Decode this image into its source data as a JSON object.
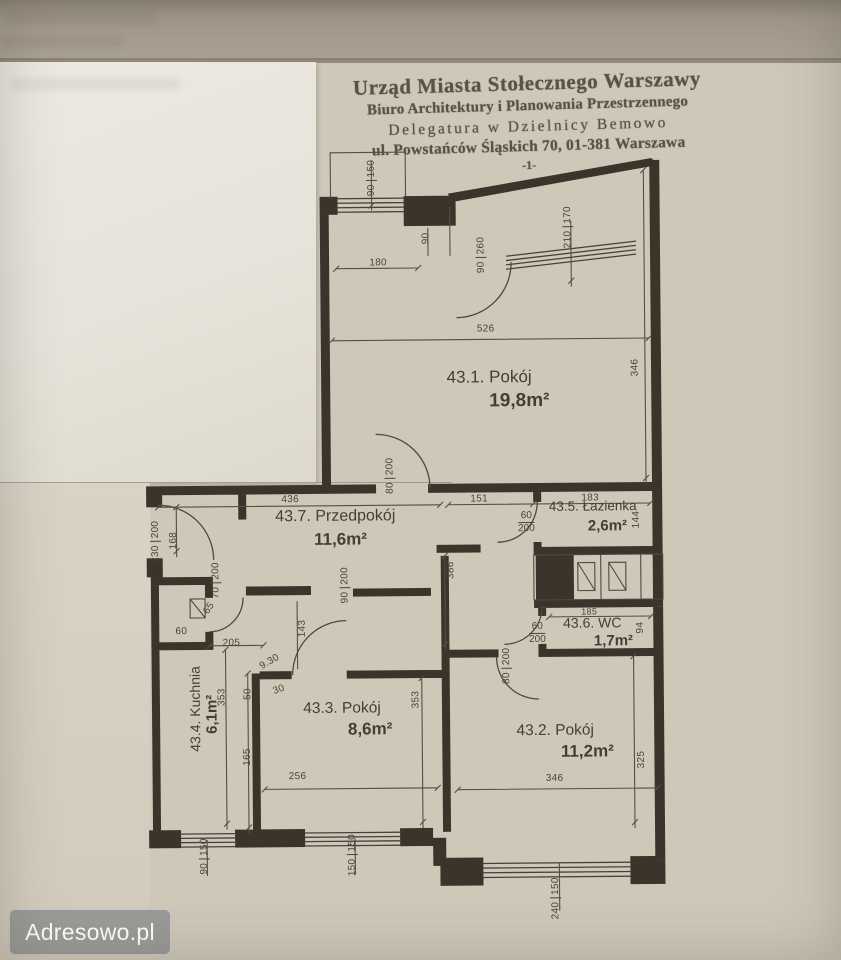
{
  "colors": {
    "paper": "#cfc8b9",
    "white_sheet": "#e9e6df",
    "ink": "#3a342b",
    "stamp_ink": "#575349",
    "watermark_bg": "#989896",
    "watermark_text": "#ffffff"
  },
  "watermark": {
    "label": "Adresowo.pl"
  },
  "stamp": {
    "line1": "Urząd Miasta Stołecznego Warszawy",
    "line2": "Biuro Architektury i Planowania Przestrzennego",
    "line3": "Delegatura w Dzielnicy Bemowo",
    "line4": "ul. Powstańców Śląskich 70, 01-381 Warszawa",
    "page_mark": "-1-"
  },
  "rooms": {
    "r1": {
      "name": "43.1. Pokój",
      "area": "19,8m²"
    },
    "r2": {
      "name": "43.2. Pokój",
      "area": "11,2m²"
    },
    "r3": {
      "name": "43.3. Pokój",
      "area": "8,6m²"
    },
    "r4": {
      "name": "43.4. Kuchnia",
      "area": "6,1m²"
    },
    "r5": {
      "name": "43.5. Łazienka",
      "area": "2,6m²"
    },
    "r6": {
      "name": "43.6. WC",
      "area": "1,7m²"
    },
    "r7": {
      "name": "43.7. Przedpokój",
      "area": "11,6m²"
    }
  },
  "dims": {
    "niche_window": {
      "n": "90",
      "d": "150"
    },
    "niche_width": "180",
    "niche_depth": "90",
    "balcony_door": {
      "n": "90",
      "d": "260"
    },
    "room1_window": {
      "n": "210",
      "d": "170"
    },
    "room1_width": "526",
    "room1_height": "346",
    "room1_door": {
      "n": "80",
      "d": "200"
    },
    "hall_width": "436",
    "seg_151": "151",
    "bath_width": "183",
    "bath_door": {
      "n": "60",
      "d": "200"
    },
    "bath_height": "144",
    "entry_door": {
      "n": "230",
      "d": "200"
    },
    "entry_height": "168",
    "closet_door": {
      "n": "70",
      "d": "200"
    },
    "closet_diag": "65",
    "closet_width": "60",
    "pass_width": "205",
    "hall_leg": "386",
    "room3_door": {
      "n": "90",
      "d": "200"
    },
    "pass_height": "143",
    "wc_width": "185",
    "wc_door": {
      "n": "60",
      "d": "200"
    },
    "wc_height": "94",
    "room2_door": {
      "n": "80",
      "d": "200"
    },
    "kitchen_level": "9.30",
    "kitchen_step": "30",
    "kitchen_50": "50",
    "kitchen_height": "353",
    "kitchen_165": "165",
    "room3_height": "353",
    "room3_width": "256",
    "room2_width": "346",
    "room2_height": "325",
    "kitchen_window": {
      "n": "90",
      "d": "150"
    },
    "room3_window": {
      "n": "150",
      "d": "150"
    },
    "bay_window": {
      "n": "240",
      "d": "150"
    }
  }
}
